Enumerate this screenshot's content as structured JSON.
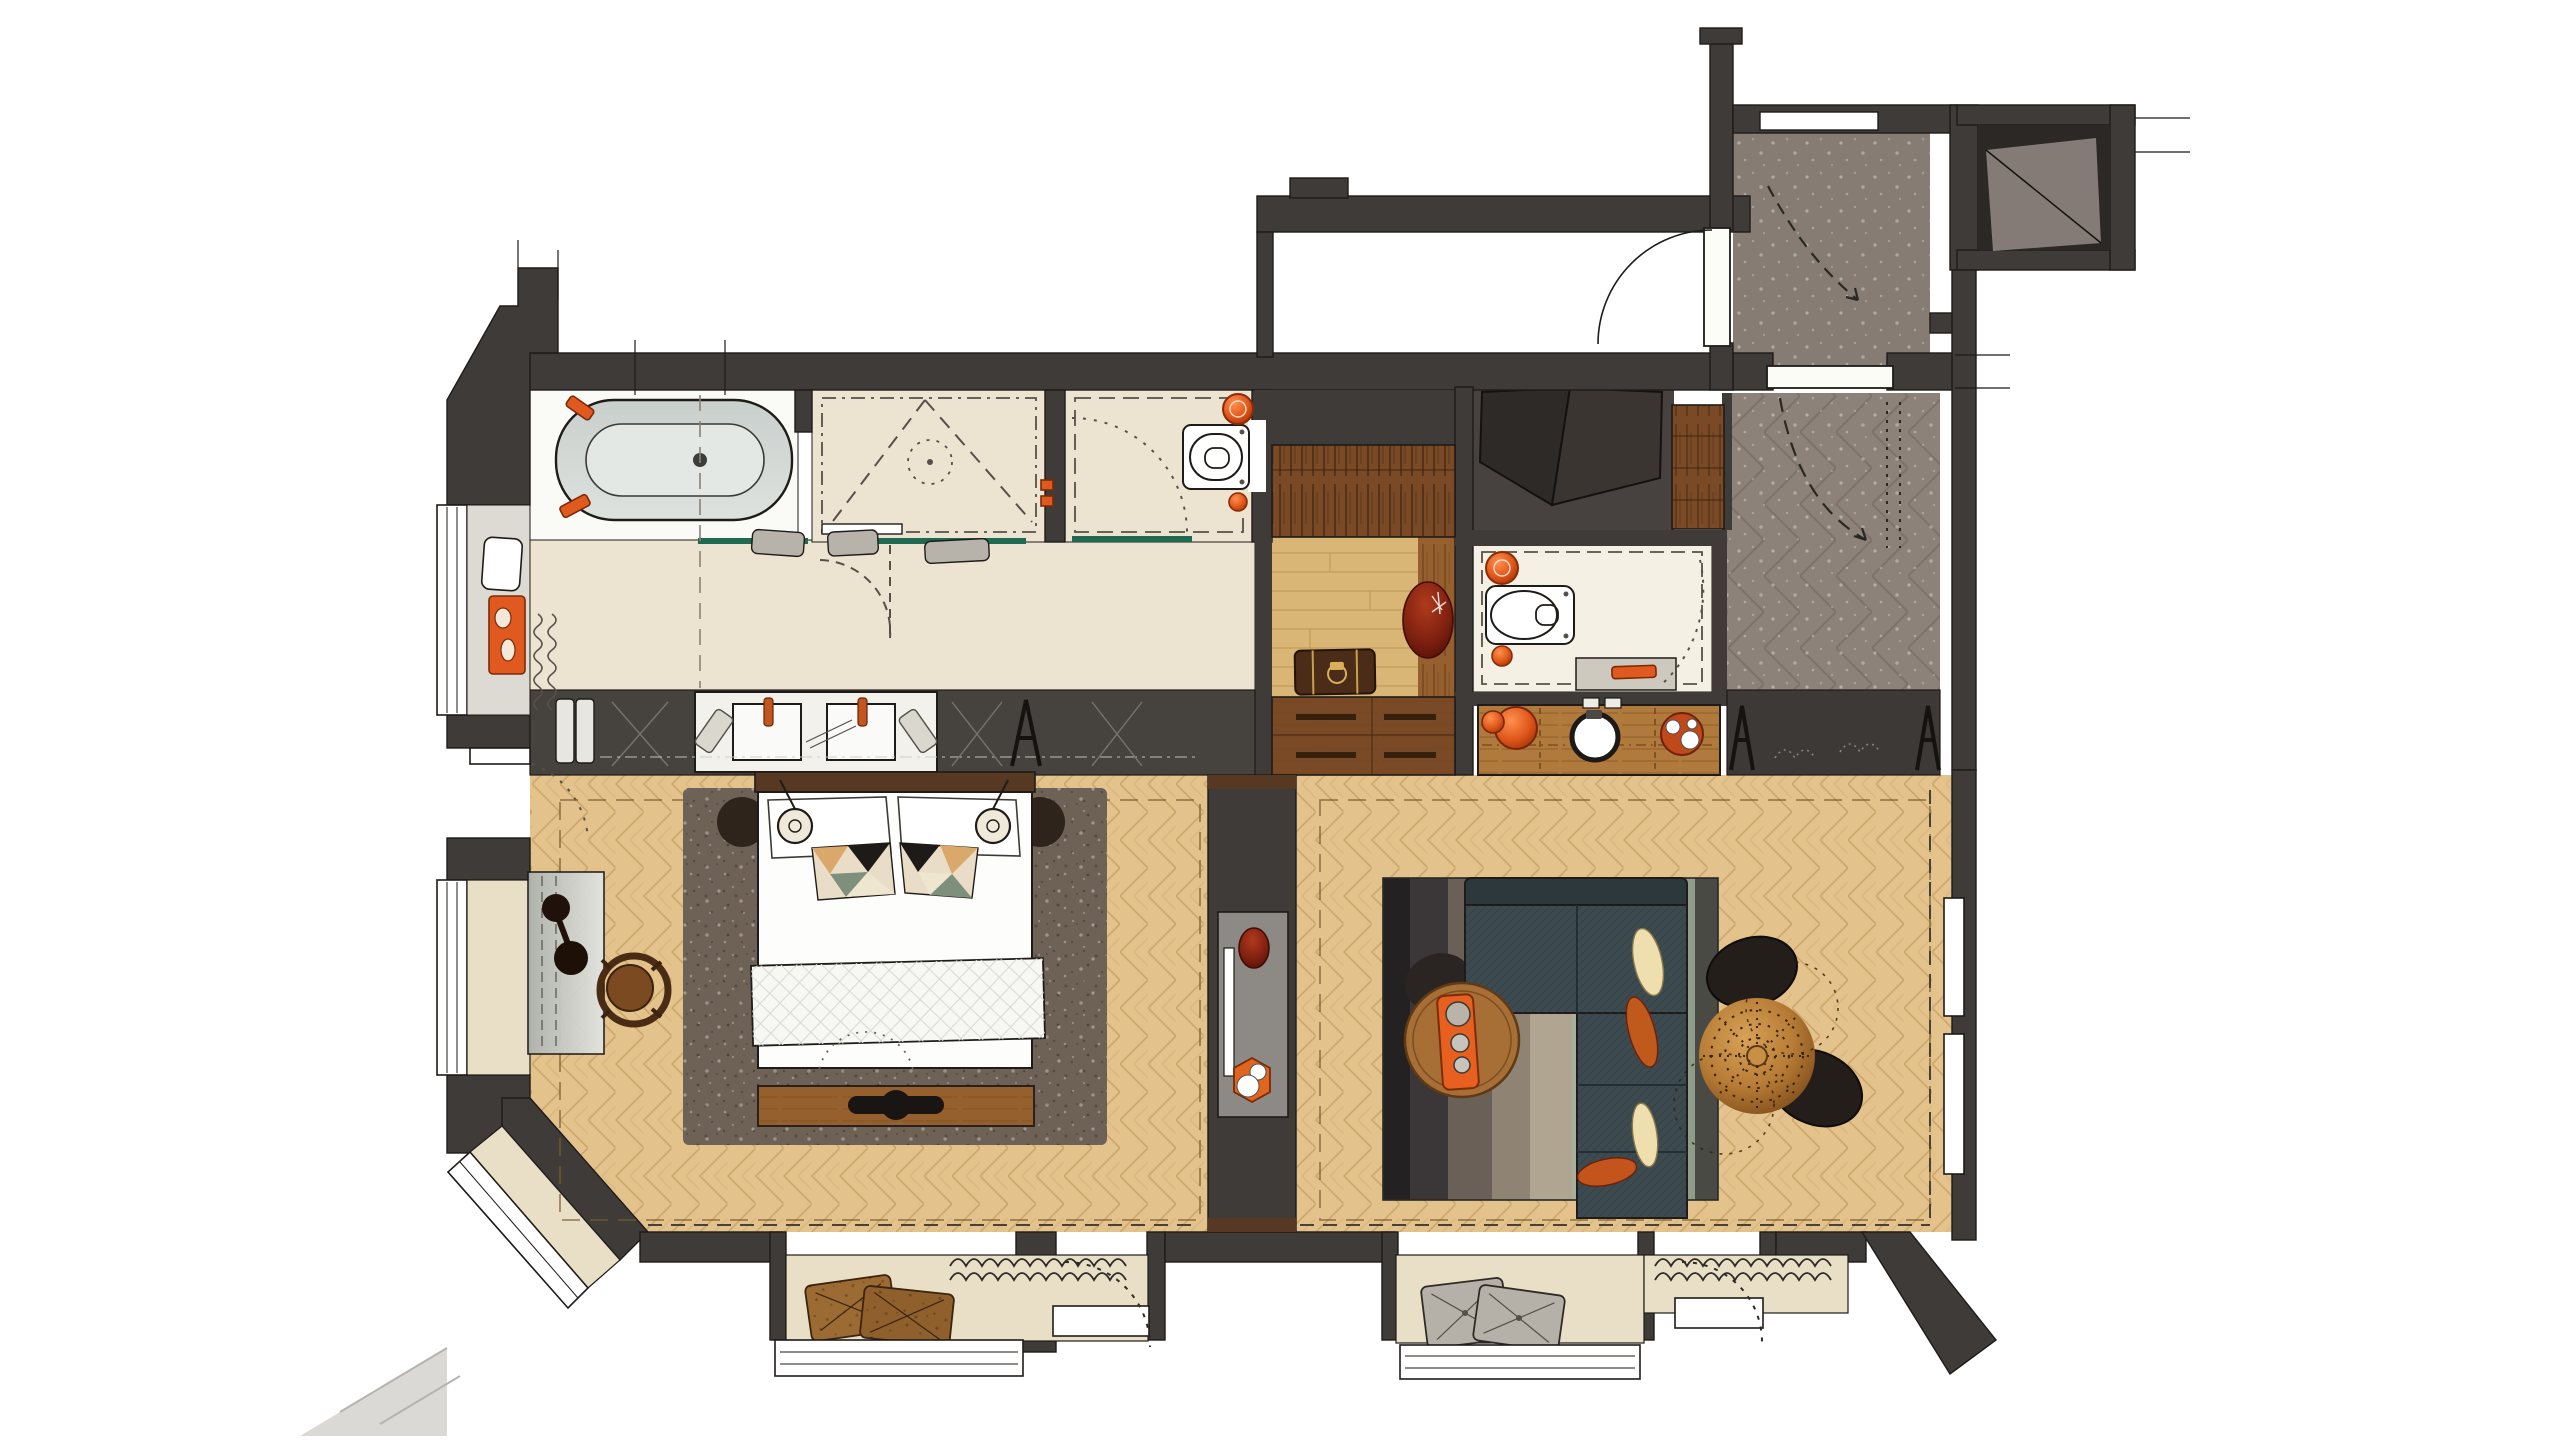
{
  "meta": {
    "kind": "hotel-suite-floor-plan-rendering",
    "canvas": {
      "width": 2560,
      "height": 1440
    },
    "visible_text": []
  },
  "palette": {
    "paper": "#ffffff",
    "wall": "#3e3b38",
    "ink": "#1e1b18",
    "sketch": "#55504a",
    "cream": "#ece4d0",
    "creamSill": "#e8dfc6",
    "floorWhite": "#fafaf7",
    "wood": "#e3c28c",
    "woodLine": "#b98f4e",
    "parquet": "#d9b676",
    "tileGray": "#8d8279",
    "tileLine": "#6a6159",
    "vestTile": "#867c74",
    "storageFloor": "#474240",
    "louver": "#847b77",
    "wardrobe": "#7a4a26",
    "wardrobeDark": "#35200e",
    "minibarWood": "#b07a3d",
    "rugBedroom": "#6e6156",
    "headboard": "#573823",
    "benchWood": "#96602e",
    "sofa": "#3d4b50",
    "sofaBack": "#2c383c",
    "glass": "#1f6a50",
    "orange": "#e05a20",
    "copper": "#b77c35",
    "chairBlack": "#231d19",
    "maroon": "#7c1f10",
    "deskGlass": "#c9cdc9",
    "towelGray": "#b7b2aa",
    "stepGray": "#dbd9d5",
    "bedWhite": "#fdfdfc",
    "creamCushion": "#efdfae",
    "orangeCushion": "#c05a1c",
    "rugStripes": [
      "#232122",
      "#3b3637",
      "#6b6057",
      "#8f8374",
      "#b0a591",
      "#a8af9c",
      "#c4c0ad",
      "#8f9c8a",
      "#4a4a44"
    ]
  },
  "rooms": [
    {
      "id": "bathroom",
      "floor": "stone-cream"
    },
    {
      "id": "shower",
      "floor": "stone-cream"
    },
    {
      "id": "wc",
      "floor": "stone-cream"
    },
    {
      "id": "dressing-corridor",
      "floor": "parquet"
    },
    {
      "id": "guest-wc",
      "floor": "stone-cream"
    },
    {
      "id": "entry-hall",
      "floor": "gray-herringbone-tile"
    },
    {
      "id": "vestibule",
      "floor": "taupe-tile"
    },
    {
      "id": "bedroom",
      "floor": "oak-herringbone"
    },
    {
      "id": "living-room",
      "floor": "oak-herringbone"
    }
  ],
  "furniture": [
    "bathtub",
    "walk-in-shower",
    "toilet",
    "double-vanity",
    "wardrobe",
    "luggage-bench",
    "suitcase",
    "guest-toilet",
    "guest-basin",
    "minibar-console",
    "valet-stand",
    "entry-closet",
    "double-bed",
    "bed-pillows",
    "bed-cushions",
    "bed-runner",
    "foot-bench",
    "bedside-pendants",
    "area-rug",
    "desk",
    "desk-lamp",
    "desk-chair",
    "tv-console",
    "striped-rug",
    "l-shaped-sofa",
    "round-coffee-table",
    "tea-tray",
    "lounge-chairs",
    "copper-pendant-sphere",
    "window-seat-cushions",
    "radiators",
    "bay-windows",
    "door-swings"
  ]
}
